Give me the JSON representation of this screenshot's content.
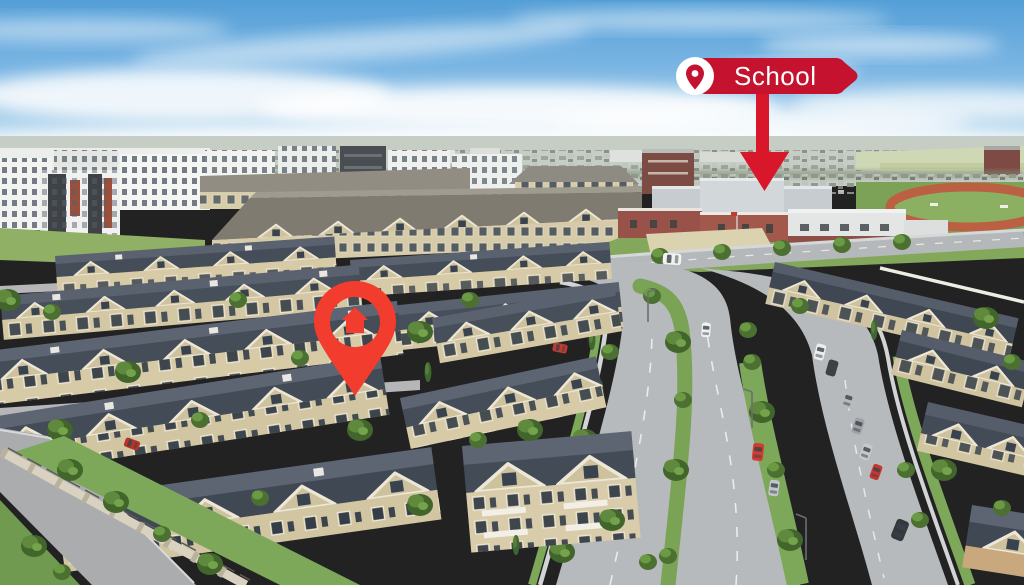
{
  "meta": {
    "description": "Aerial drone photograph of a suburban townhouse complex; a red map pin marks the listed property and a red signpost with an arrow marks the nearby school.",
    "width": 1024,
    "height": 585
  },
  "overlays": {
    "school_banner": {
      "label": "School",
      "banner_color": "#c5122f",
      "text_color": "#ffffff",
      "pin_icon_color": "#c5122f",
      "pin_icon_bg": "#ffffff"
    },
    "pointer_arrow": {
      "color": "#d8172b",
      "direction": "down",
      "target": "school building"
    },
    "property_pin": {
      "color": "#f23c2e",
      "glyph": "house",
      "center": "transparent cutout showing marked townhouse"
    }
  },
  "scene": {
    "sky_color": "#6fb0e0",
    "townhouse_roof_color": "#454d59",
    "townhouse_wall_color": "#d6caa7",
    "grass_color": "#7aa355",
    "road_color": "#b7babc",
    "tree_color": "#5d8a3e",
    "running_track_color": "#bc6044",
    "school_brick_color": "#9e5246"
  }
}
